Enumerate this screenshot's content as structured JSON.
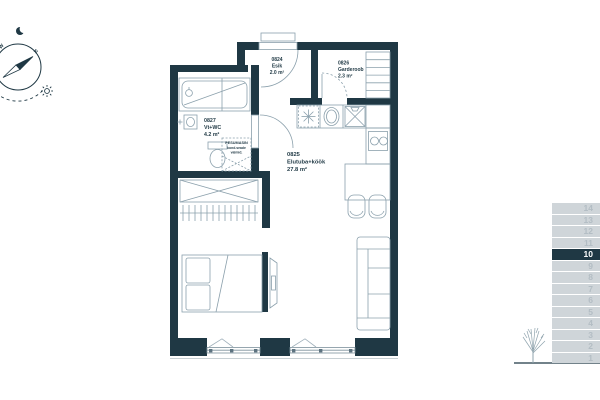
{
  "colors": {
    "wall": "#1f3844",
    "thin_line": "#8ba0ac",
    "floor_row_bg": "#cfd5d9",
    "floor_row_text": "#b3bdc4",
    "floor_row_active_bg": "#1f3844",
    "floor_row_active_text": "#ffffff",
    "tree": "#8fa3ad"
  },
  "compass": {
    "north_label": "N",
    "west_label": "W"
  },
  "rooms": [
    {
      "code": "0824",
      "name": "Esik",
      "area": "2.0 m²"
    },
    {
      "code": "0826",
      "name": "Garderoob",
      "area": "2.3 m²"
    },
    {
      "code": "0827",
      "name": "Vt+WC",
      "area": "4.2 m²"
    },
    {
      "code": "0825",
      "name": "Elutuba+köök",
      "area": "27.8 m²"
    }
  ],
  "annotations": {
    "washing_machine": {
      "line1": "PESUMASIN",
      "line2": "kond.seade",
      "line3": "valmid."
    }
  },
  "floor_indicator": {
    "current_floor": "10",
    "floors": [
      "14",
      "13",
      "12",
      "11",
      "10",
      "9",
      "8",
      "7",
      "6",
      "5",
      "4",
      "3",
      "2",
      "1"
    ]
  }
}
